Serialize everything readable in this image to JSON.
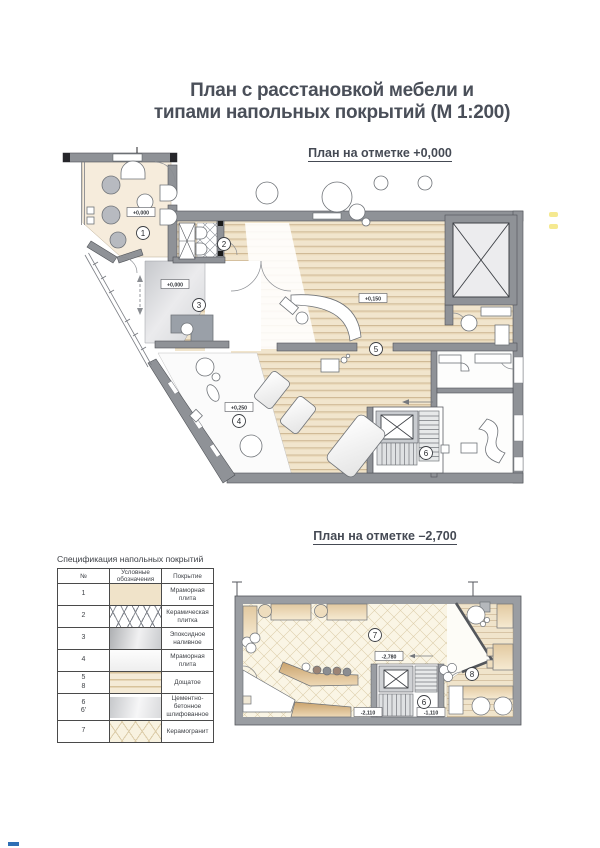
{
  "header": {
    "title_line1": "План с расстановкой мебели и",
    "title_line2": "типами напольных покрытий (М 1:200)"
  },
  "upper_plan": {
    "caption": "План на отметке +0,000",
    "rooms": [
      {
        "number": "1",
        "elevation": "+0,000"
      },
      {
        "number": "2"
      },
      {
        "number": "3",
        "elevation": "+0,000"
      },
      {
        "number": "4",
        "elevation": "+0,250"
      },
      {
        "number": "5",
        "elevation": "+0,150"
      },
      {
        "number": "6"
      }
    ]
  },
  "lower_plan": {
    "caption": "План на отметке –2,700",
    "rooms": [
      {
        "number": "7"
      },
      {
        "number": "8"
      },
      {
        "number": "6"
      }
    ],
    "elevations": {
      "main": "-2,780",
      "left": "-2,110",
      "right": "-1,110"
    }
  },
  "spec_table": {
    "title": "Спецификация напольных покрытий",
    "headers": {
      "num": "№",
      "symbol": "Условные обозначения",
      "covering": "Покрытие"
    },
    "rows": [
      {
        "num": "1",
        "covering": "Мраморная плита"
      },
      {
        "num": "2",
        "covering": "Керамическая плитка"
      },
      {
        "num": "3",
        "covering": "Эпоксидное наливное"
      },
      {
        "num": "4",
        "covering": "Мраморная плита"
      },
      {
        "num": "5",
        "num2": "8",
        "covering": "Дощатое"
      },
      {
        "num": "6",
        "num2": "6'",
        "covering": "Цементно-бетонное шлифованное"
      },
      {
        "num": "7",
        "covering": "Керамогранит"
      }
    ]
  },
  "colors": {
    "title_text": "#4a4f59",
    "wall": "#8f9297",
    "floor_marble_beige": "#f6ecdc",
    "floor_plank": "#f1e5cd",
    "floor_epoxy": "#d9dade",
    "floor_marble_white": "#fbfbfb",
    "floor_porcelain": "#faf5e5",
    "accent_blue": "#2f6fb5"
  }
}
